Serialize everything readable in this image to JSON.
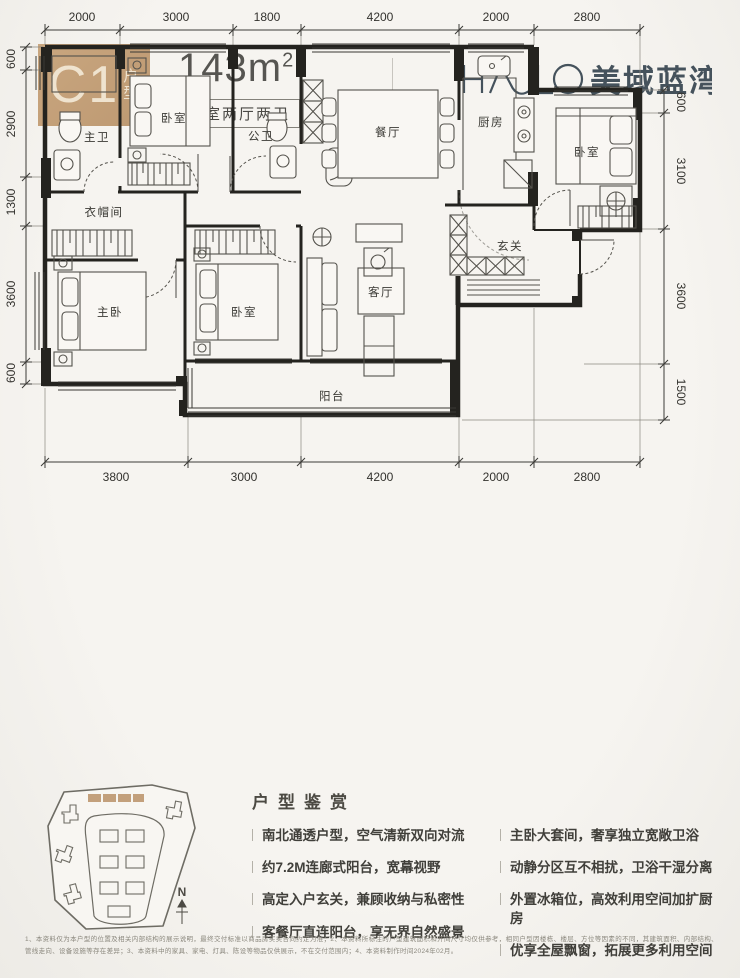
{
  "header": {
    "unit_code": "C1",
    "unit_label_1": "户",
    "unit_label_2": "型",
    "area_value": "143m",
    "area_exp": "2",
    "spec": "四室两厅两卫",
    "brand_cn": "美域蓝湾",
    "brand_color": "#45525c",
    "accent_tan": "#c3a07c"
  },
  "plan": {
    "dims_top": [
      "2000",
      "3000",
      "1800",
      "4200",
      "2000",
      "2800"
    ],
    "dims_bottom": [
      "3800",
      "3000",
      "4200",
      "2000",
      "2800"
    ],
    "dims_left": [
      "600",
      "2900",
      "1300",
      "3600",
      "600"
    ],
    "dims_right": [
      "600",
      "3100",
      "3600",
      "1500"
    ],
    "rooms": {
      "master_bath": "主卫",
      "bedroom_a": "卧室",
      "guest_bath": "公卫",
      "dining": "餐厅",
      "kitchen": "厨房",
      "bedroom_b": "卧室",
      "cloakroom": "衣帽间",
      "foyer": "玄关",
      "master_bedroom": "主卧",
      "bedroom_c": "卧室",
      "living": "客厅",
      "balcony": "阳台"
    }
  },
  "site": {
    "compass": "N"
  },
  "features": {
    "title": "户型鉴赏",
    "left": [
      "南北通透户型，空气清新双向对流",
      "约7.2M连廊式阳台，宽幕视野",
      "高定入户玄关，兼顾收纳与私密性",
      "客餐厅直连阳台，享无界自然盛景"
    ],
    "right": [
      "主卧大套间，奢享独立宽敞卫浴",
      "动静分区互不相扰，卫浴干湿分离",
      "外置冰箱位，高效利用空间加扩厨房",
      "优享全屋飘窗，拓展更多利用空间"
    ]
  },
  "disclaimer": "1、本资料仅为本户型的位置及相关内部结构的展示说明，最终交付标准以商品房买卖合同约定为准；2、本资料所标注的户型建筑面积和开间尺寸均仅供参考，相同户型因楼栋、楼层、方位等因素的不同，其建筑面积、内部结构、管线走向、设备设施等存在差异；3、本资料中的家具、家电、灯具、陈设等物品仅供展示，不在交付范围内；4、本资料制作时间2024年02月。"
}
